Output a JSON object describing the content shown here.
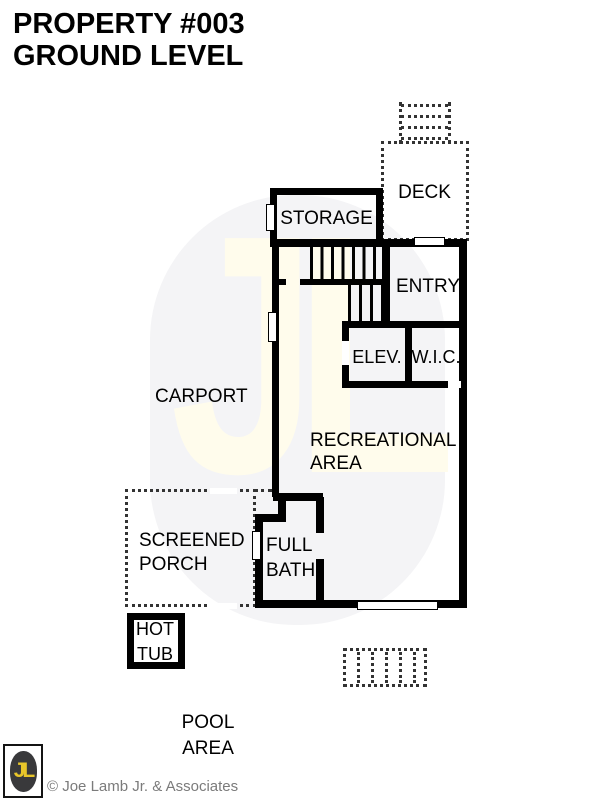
{
  "title": {
    "line1": "PROPERTY #003",
    "line2": "GROUND LEVEL"
  },
  "plan": {
    "labels": {
      "deck": "DECK",
      "storage": "STORAGE",
      "entry": "ENTRY",
      "elevator": "ELEV.",
      "closet": "W.I.C.",
      "carport": "CARPORT",
      "recreational": "RECREATIONAL\nAREA",
      "screened_porch": "SCREENED\nPORCH",
      "full_bath": "FULL\nBATH",
      "hot_tub": "HOT\nTUB",
      "pool_area": "POOL\nAREA"
    }
  },
  "branding": {
    "logo_monogram": "JL",
    "watermark_monogram": "JL",
    "copyright": "© Joe Lamb Jr. & Associates",
    "colors": {
      "wall_black": "#000000",
      "logo_yellow": "#e8c62a",
      "logo_dark": "#39393b",
      "watermark_letters": "#fffcec",
      "watermark_oval": "#f4f4f6",
      "copyright_gray": "#7b7b7b"
    }
  }
}
